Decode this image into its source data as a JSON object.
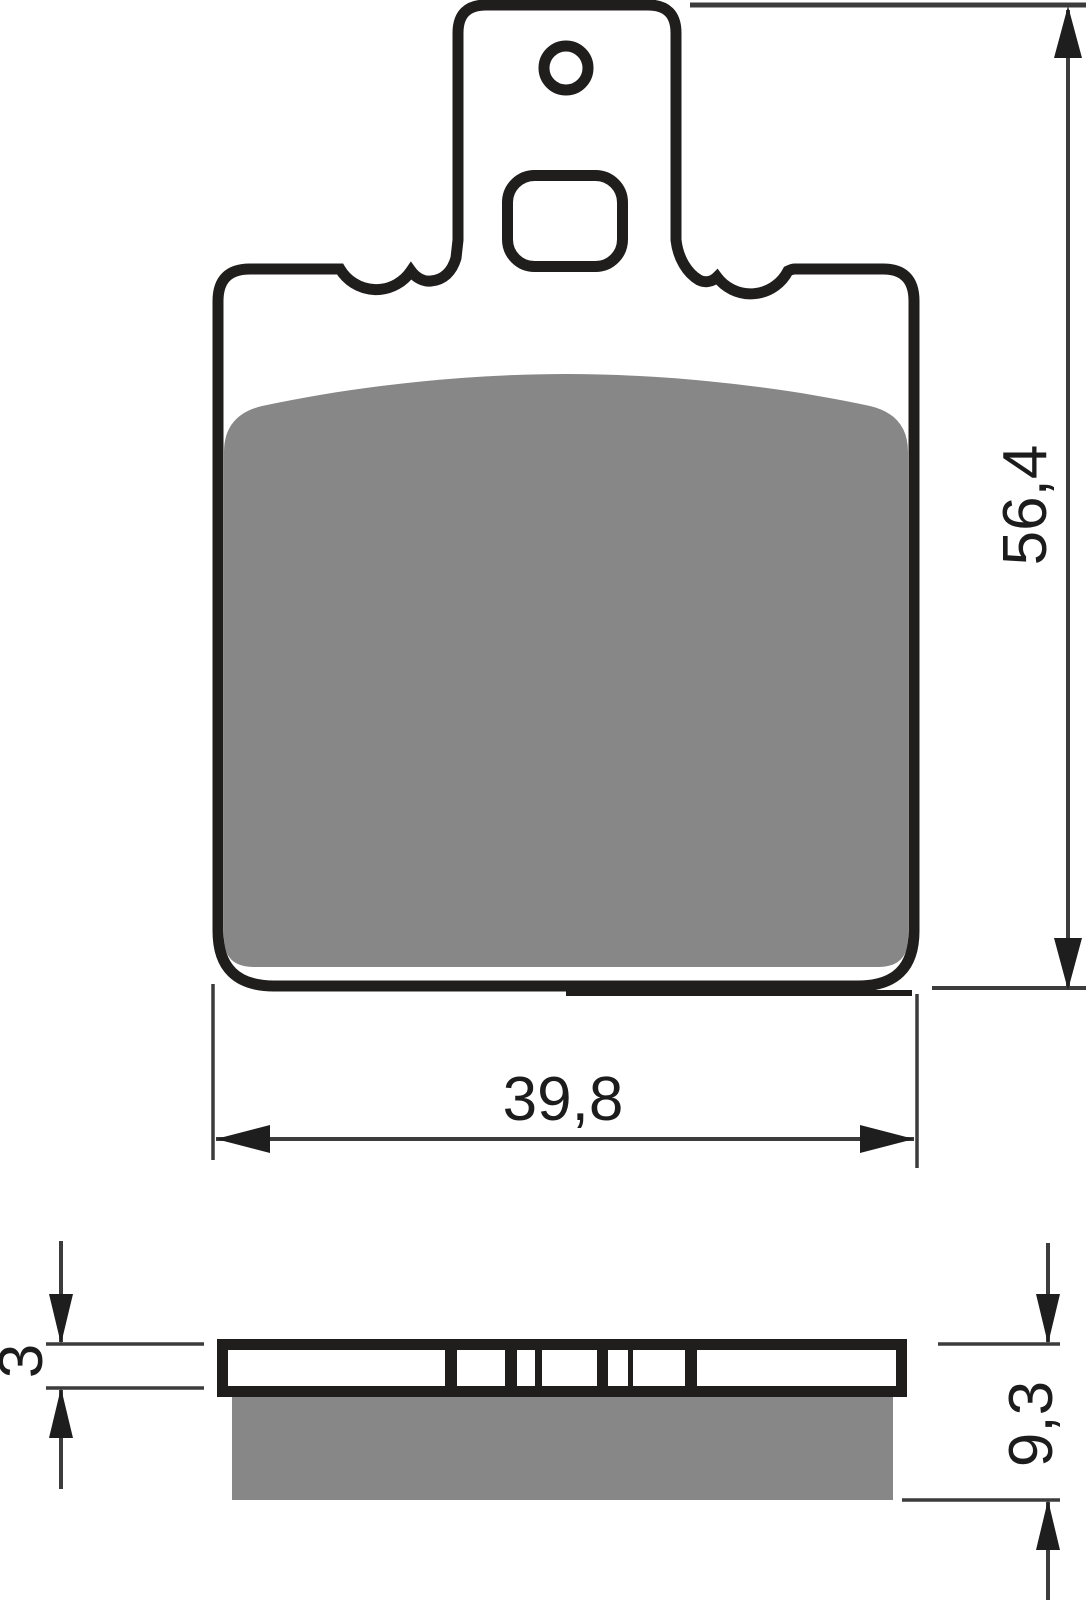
{
  "dimensions": {
    "front_width": "39,8",
    "front_height": "56,4",
    "backing_plate_thickness": "3",
    "total_thickness": "9,3"
  },
  "colors": {
    "background": "#ffffff",
    "outline": "#201d1d",
    "friction_material": "#878787",
    "dimension_line": "#3c3c3c",
    "arrow": "#1e1e1e"
  }
}
